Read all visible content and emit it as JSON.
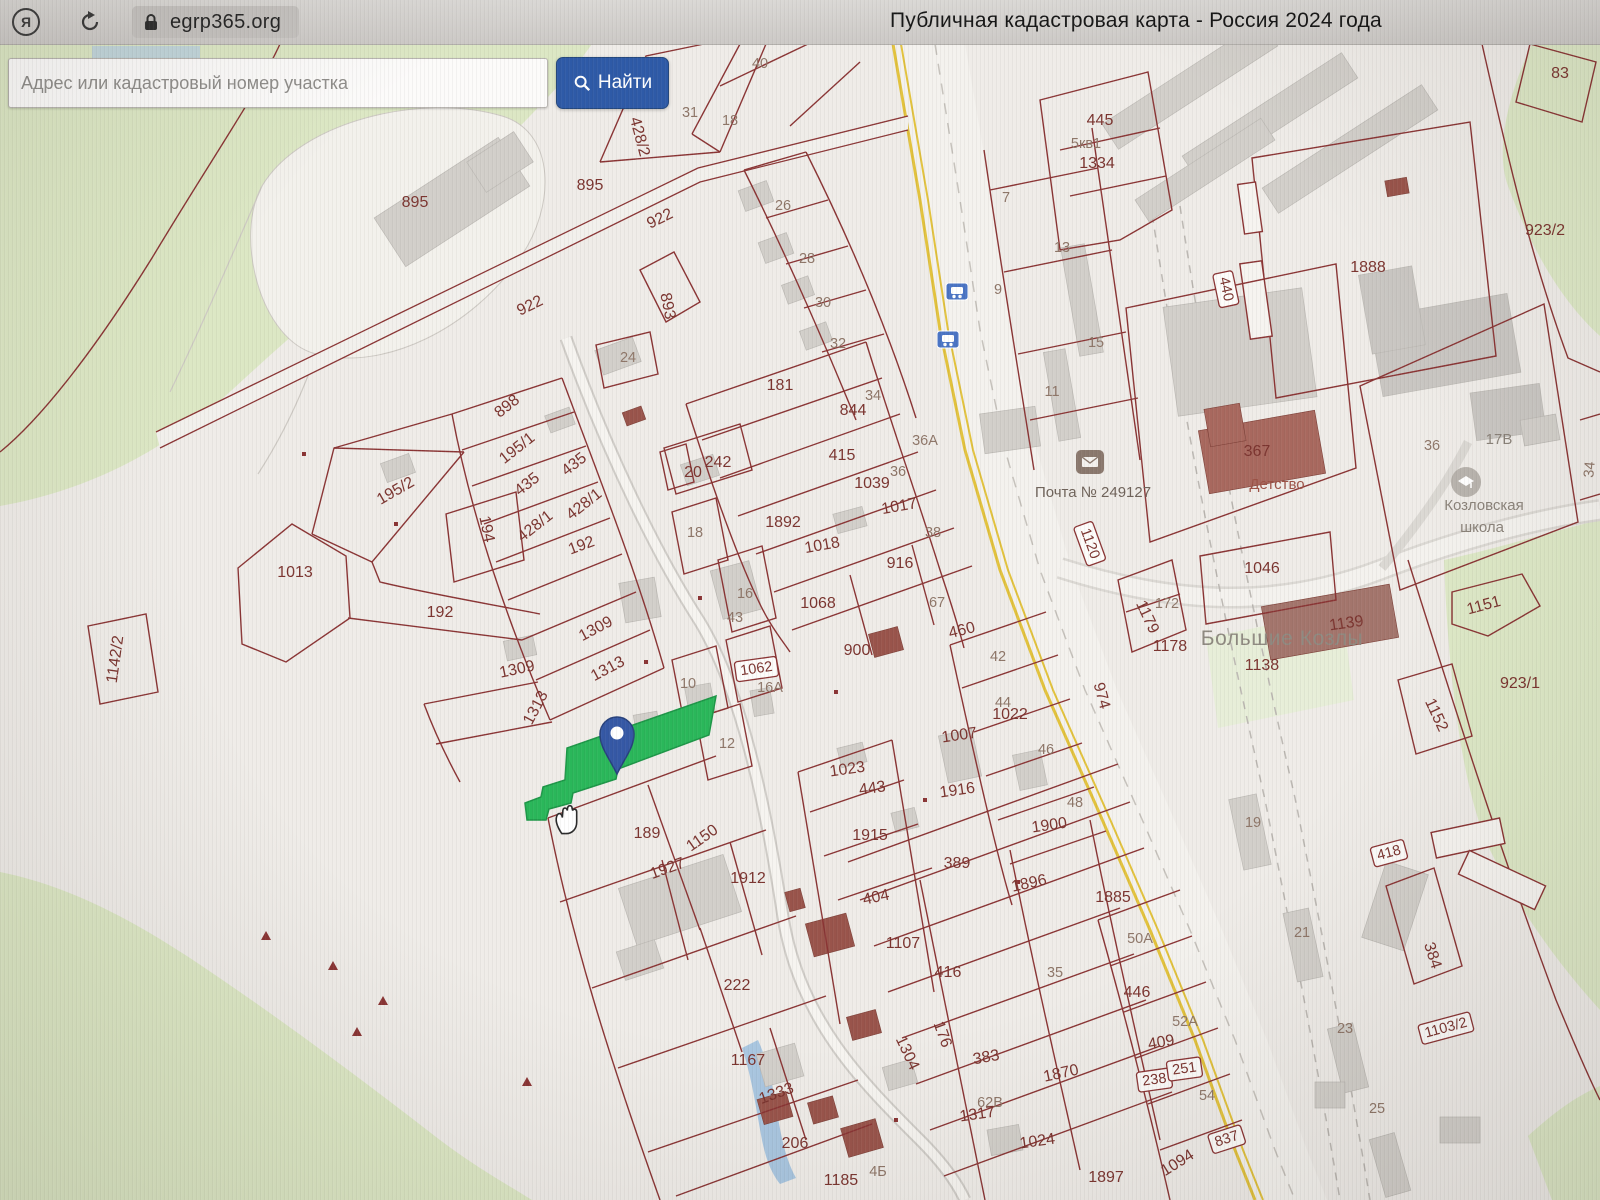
{
  "browser": {
    "logo_letter": "Я",
    "url": "egrp365.org",
    "page_title": "Публичная кадастровая карта - Россия 2024 года"
  },
  "search": {
    "placeholder": "Адрес или кадастровый номер участка",
    "button_label": "Найти"
  },
  "icons": {
    "browser_logo": "yandex-logo",
    "reload": "reload-arrow",
    "lock": "padlock",
    "search": "magnifier",
    "post_office": "envelope",
    "school": "graduation-building",
    "bus_stop": "bus",
    "pin": "map-pin",
    "hand": "hand-cursor"
  },
  "colors": {
    "accent_blue": "#2e5aa7",
    "parcel_line": "#8a3434",
    "parcel_label": "#7b342f",
    "house_label": "#8e7668",
    "selected_parcel_green": "#2ab75a",
    "road_yellow": "#e2c23d",
    "map_background": "#efece8",
    "green_area": "#dce7c4",
    "building_gray": "#d2cfca",
    "building_red": "#99544b",
    "pin_blue": "#3558a5"
  },
  "map": {
    "town_label": "Большие Козлы",
    "labels": [
      {
        "t": "40",
        "x": 760,
        "y": 68,
        "c": "s"
      },
      {
        "t": "31",
        "x": 690,
        "y": 117,
        "c": "s"
      },
      {
        "t": "18",
        "x": 730,
        "y": 125,
        "c": "s"
      },
      {
        "t": "428/2",
        "x": 635,
        "y": 138,
        "r": 75
      },
      {
        "t": "895",
        "x": 590,
        "y": 190
      },
      {
        "t": "895",
        "x": 415,
        "y": 207
      },
      {
        "t": "922",
        "x": 662,
        "y": 223,
        "r": -26
      },
      {
        "t": "922",
        "x": 532,
        "y": 310,
        "r": -26
      },
      {
        "t": "893",
        "x": 663,
        "y": 307,
        "r": 78
      },
      {
        "t": "26",
        "x": 783,
        "y": 210,
        "c": "s"
      },
      {
        "t": "28",
        "x": 807,
        "y": 263,
        "c": "s"
      },
      {
        "t": "30",
        "x": 823,
        "y": 307,
        "c": "s"
      },
      {
        "t": "32",
        "x": 838,
        "y": 348,
        "c": "s"
      },
      {
        "t": "24",
        "x": 628,
        "y": 362,
        "c": "s"
      },
      {
        "t": "181",
        "x": 780,
        "y": 390
      },
      {
        "t": "34",
        "x": 873,
        "y": 400,
        "c": "s"
      },
      {
        "t": "844",
        "x": 853,
        "y": 415
      },
      {
        "t": "36А",
        "x": 925,
        "y": 445,
        "c": "s"
      },
      {
        "t": "415",
        "x": 842,
        "y": 460
      },
      {
        "t": "1039",
        "x": 872,
        "y": 488
      },
      {
        "t": "36",
        "x": 898,
        "y": 476,
        "c": "s"
      },
      {
        "t": "242",
        "x": 718,
        "y": 467
      },
      {
        "t": "20",
        "x": 693,
        "y": 477
      },
      {
        "t": "1892",
        "x": 783,
        "y": 527
      },
      {
        "t": "1017",
        "x": 900,
        "y": 511,
        "r": -10
      },
      {
        "t": "38",
        "x": 933,
        "y": 537,
        "c": "s"
      },
      {
        "t": "1018",
        "x": 823,
        "y": 550,
        "r": -10
      },
      {
        "t": "18",
        "x": 695,
        "y": 537,
        "c": "s"
      },
      {
        "t": "916",
        "x": 900,
        "y": 568
      },
      {
        "t": "1068",
        "x": 818,
        "y": 608
      },
      {
        "t": "16",
        "x": 745,
        "y": 598,
        "c": "s"
      },
      {
        "t": "43",
        "x": 735,
        "y": 622,
        "c": "s"
      },
      {
        "t": "67",
        "x": 937,
        "y": 607,
        "c": "s"
      },
      {
        "t": "460",
        "x": 963,
        "y": 635,
        "r": -14
      },
      {
        "t": "900",
        "x": 857,
        "y": 655
      },
      {
        "t": "42",
        "x": 998,
        "y": 661,
        "c": "s"
      },
      {
        "t": "898",
        "x": 510,
        "y": 410,
        "r": -38
      },
      {
        "t": "195/1",
        "x": 520,
        "y": 452,
        "r": -38
      },
      {
        "t": "435",
        "x": 577,
        "y": 468,
        "r": -38
      },
      {
        "t": "435",
        "x": 530,
        "y": 488,
        "r": -38
      },
      {
        "t": "428/1",
        "x": 587,
        "y": 508,
        "r": -38
      },
      {
        "t": "428/1",
        "x": 538,
        "y": 530,
        "r": -38
      },
      {
        "t": "194",
        "x": 482,
        "y": 530,
        "r": 78
      },
      {
        "t": "195/2",
        "x": 398,
        "y": 495,
        "r": -30
      },
      {
        "t": "192",
        "x": 583,
        "y": 550,
        "r": -20
      },
      {
        "t": "1013",
        "x": 295,
        "y": 577
      },
      {
        "t": "192",
        "x": 440,
        "y": 617
      },
      {
        "t": "1309",
        "x": 598,
        "y": 633,
        "r": -28
      },
      {
        "t": "1309",
        "x": 518,
        "y": 674,
        "r": -12
      },
      {
        "t": "1313",
        "x": 610,
        "y": 673,
        "r": -28
      },
      {
        "t": "1313",
        "x": 540,
        "y": 710,
        "r": -62
      },
      {
        "t": "1142/2",
        "x": 120,
        "y": 660,
        "r": -82
      },
      {
        "t": "10",
        "x": 688,
        "y": 688,
        "c": "s"
      },
      {
        "t": "1062",
        "x": 757,
        "y": 673,
        "r": -8,
        "c": "p"
      },
      {
        "t": "16А",
        "x": 770,
        "y": 692,
        "c": "s"
      },
      {
        "t": "12",
        "x": 727,
        "y": 748,
        "c": "s"
      },
      {
        "t": "44",
        "x": 1003,
        "y": 707,
        "c": "s"
      },
      {
        "t": "1022",
        "x": 1010,
        "y": 719
      },
      {
        "t": "1007",
        "x": 960,
        "y": 740,
        "r": -8
      },
      {
        "t": "46",
        "x": 1046,
        "y": 754,
        "c": "s"
      },
      {
        "t": "1916",
        "x": 958,
        "y": 795,
        "r": -8
      },
      {
        "t": "48",
        "x": 1075,
        "y": 807,
        "c": "s"
      },
      {
        "t": "1900",
        "x": 1050,
        "y": 830,
        "r": -8
      },
      {
        "t": "1023",
        "x": 848,
        "y": 774,
        "r": -8
      },
      {
        "t": "443",
        "x": 873,
        "y": 793,
        "r": -8
      },
      {
        "t": "1915",
        "x": 870,
        "y": 840
      },
      {
        "t": "389",
        "x": 957,
        "y": 868
      },
      {
        "t": "1896",
        "x": 1030,
        "y": 888,
        "r": -12
      },
      {
        "t": "1885",
        "x": 1113,
        "y": 902
      },
      {
        "t": "404",
        "x": 877,
        "y": 902,
        "r": -12
      },
      {
        "t": "1107",
        "x": 903,
        "y": 948
      },
      {
        "t": "416",
        "x": 948,
        "y": 977
      },
      {
        "t": "35",
        "x": 1055,
        "y": 977,
        "c": "s"
      },
      {
        "t": "189",
        "x": 647,
        "y": 838
      },
      {
        "t": "1150",
        "x": 705,
        "y": 842,
        "r": -35
      },
      {
        "t": "1927",
        "x": 669,
        "y": 873,
        "r": -20
      },
      {
        "t": "1912",
        "x": 748,
        "y": 883
      },
      {
        "t": "222",
        "x": 737,
        "y": 990
      },
      {
        "t": "1167",
        "x": 748,
        "y": 1065
      },
      {
        "t": "1333",
        "x": 778,
        "y": 1098,
        "r": -20
      },
      {
        "t": "206",
        "x": 795,
        "y": 1148
      },
      {
        "t": "1185",
        "x": 841,
        "y": 1185
      },
      {
        "t": "4Б",
        "x": 878,
        "y": 1176,
        "c": "s"
      },
      {
        "t": "1304",
        "x": 903,
        "y": 1055,
        "r": 65
      },
      {
        "t": "176",
        "x": 938,
        "y": 1036,
        "r": 70
      },
      {
        "t": "383",
        "x": 987,
        "y": 1062,
        "r": -10
      },
      {
        "t": "1870",
        "x": 1062,
        "y": 1078,
        "r": -12
      },
      {
        "t": "62В",
        "x": 990,
        "y": 1107,
        "c": "s"
      },
      {
        "t": "1317",
        "x": 978,
        "y": 1119,
        "r": -8
      },
      {
        "t": "1024",
        "x": 1038,
        "y": 1146,
        "r": -8
      },
      {
        "t": "1897",
        "x": 1106,
        "y": 1182
      },
      {
        "t": "409",
        "x": 1162,
        "y": 1047,
        "r": -10
      },
      {
        "t": "238",
        "x": 1155,
        "y": 1084,
        "r": -8,
        "c": "p"
      },
      {
        "t": "251",
        "x": 1185,
        "y": 1073,
        "r": -8,
        "c": "p"
      },
      {
        "t": "54",
        "x": 1207,
        "y": 1100,
        "c": "s"
      },
      {
        "t": "837",
        "x": 1228,
        "y": 1143,
        "r": -18,
        "c": "p"
      },
      {
        "t": "1094",
        "x": 1180,
        "y": 1167,
        "r": -32
      },
      {
        "t": "50А",
        "x": 1140,
        "y": 943,
        "c": "s"
      },
      {
        "t": "446",
        "x": 1137,
        "y": 997
      },
      {
        "t": "52А",
        "x": 1185,
        "y": 1026,
        "c": "s"
      },
      {
        "t": "19",
        "x": 1253,
        "y": 827,
        "c": "s"
      },
      {
        "t": "21",
        "x": 1302,
        "y": 937,
        "c": "s"
      },
      {
        "t": "23",
        "x": 1345,
        "y": 1033,
        "c": "s"
      },
      {
        "t": "25",
        "x": 1377,
        "y": 1113,
        "c": "s"
      },
      {
        "t": "418",
        "x": 1390,
        "y": 857,
        "r": -15,
        "c": "p"
      },
      {
        "t": "384",
        "x": 1428,
        "y": 957,
        "r": 72
      },
      {
        "t": "1103/2",
        "x": 1447,
        "y": 1032,
        "r": -15,
        "c": "p"
      },
      {
        "t": "974",
        "x": 1097,
        "y": 697,
        "r": 75
      },
      {
        "t": "1120",
        "x": 1086,
        "y": 545,
        "r": 70,
        "c": "p"
      },
      {
        "t": "Почта № 249127",
        "x": 1093,
        "y": 497,
        "c": "o"
      },
      {
        "t": "367",
        "x": 1257,
        "y": 456
      },
      {
        "t": "Детство",
        "x": 1277,
        "y": 489,
        "c": "k"
      },
      {
        "t": "36",
        "x": 1432,
        "y": 450,
        "c": "s"
      },
      {
        "t": "17В",
        "x": 1499,
        "y": 444,
        "c": "g"
      },
      {
        "t": "Козловская",
        "x": 1484,
        "y": 510,
        "c": "g"
      },
      {
        "t": "школа",
        "x": 1482,
        "y": 532,
        "c": "g"
      },
      {
        "t": "1046",
        "x": 1262,
        "y": 573
      },
      {
        "t": "1179",
        "x": 1143,
        "y": 619,
        "r": 65
      },
      {
        "t": "172",
        "x": 1167,
        "y": 608,
        "c": "s"
      },
      {
        "t": "1178",
        "x": 1170,
        "y": 651
      },
      {
        "t": "Большие Козлы",
        "x": 1282,
        "y": 645,
        "c": "t"
      },
      {
        "t": "1139",
        "x": 1347,
        "y": 628,
        "r": -8
      },
      {
        "t": "1138",
        "x": 1262,
        "y": 670
      },
      {
        "t": "1151",
        "x": 1485,
        "y": 610,
        "r": -15
      },
      {
        "t": "1152",
        "x": 1432,
        "y": 717,
        "r": 65
      },
      {
        "t": "923/1",
        "x": 1520,
        "y": 688
      },
      {
        "t": "923/2",
        "x": 1545,
        "y": 235
      },
      {
        "t": "1888",
        "x": 1368,
        "y": 272
      },
      {
        "t": "440",
        "x": 1222,
        "y": 290,
        "r": 78,
        "c": "p"
      },
      {
        "t": "445",
        "x": 1100,
        "y": 125
      },
      {
        "t": "5кв1",
        "x": 1086,
        "y": 148,
        "c": "s"
      },
      {
        "t": "1334",
        "x": 1097,
        "y": 168
      },
      {
        "t": "7",
        "x": 1006,
        "y": 202,
        "c": "s"
      },
      {
        "t": "13",
        "x": 1062,
        "y": 252,
        "c": "s"
      },
      {
        "t": "9",
        "x": 998,
        "y": 294,
        "c": "s"
      },
      {
        "t": "15",
        "x": 1096,
        "y": 347,
        "c": "s"
      },
      {
        "t": "11",
        "x": 1052,
        "y": 396,
        "c": "s"
      },
      {
        "t": "83",
        "x": 1560,
        "y": 78
      },
      {
        "t": "34",
        "x": 1594,
        "y": 470,
        "r": -85,
        "c": "s"
      }
    ]
  }
}
